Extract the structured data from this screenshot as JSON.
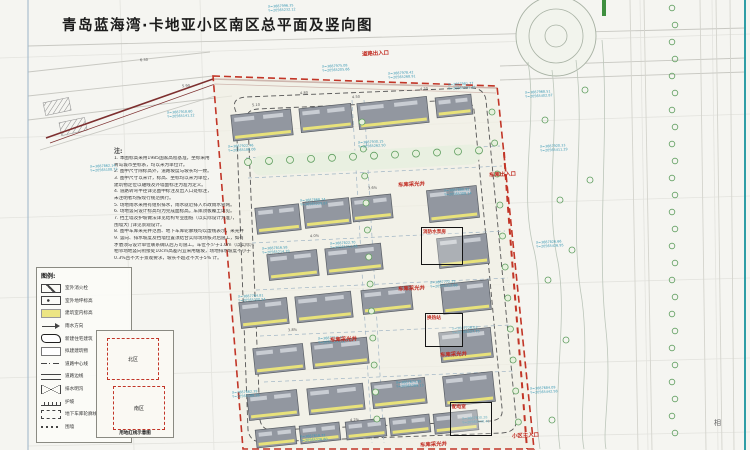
{
  "title": "青岛蓝海湾·卡地亚小区南区总平面及竖向图",
  "notes": {
    "header": "注:",
    "lines": [
      "1. 本图标高采用1985国家高程基准，坐标采用",
      "   青岛城市坐标系，均以米为单位计。",
      "2. 图中尺寸除标高外，道路坡度与坡长均一致。",
      "3. 图中尺寸以米计，标高、坐标均以米为单位，",
      "   建筑物定位以轴线及外墙面标注为准为定义。",
      "4. 道路转弯半径详见图中标注及出入口处标注，",
      "   未注明者均按现行规范执行。",
      "5. 场地雨水采用有组织排水，雨水就近排入市政雨水管网。",
      "6. 场地竖向设计标高均为完成面标高，车库顶板覆土详见。",
      "7. 挡土墙及护坡做法详见结构专业图纸（以实际设计为准），",
      "   围墙大门详见景观设计。",
      "8. 图中车库采光井范围、地下车库轮廓线均以虚线表示，采光井",
      "9. 竖向、排水坡度及挡墙位置须结合实际现场核对后施工，如有",
      "   矛盾须与设计单位联系确认后方可施工。车位不少于1.0m（以实际），",
      "   相邻场地竖向衔接处10cm高差内宜采用缓坡，场地排水坡度不小于",
      "   0.3%且不大于景观要求，坡长不超过不大于5% 计。"
    ]
  },
  "legend": {
    "header": "图例:",
    "items": [
      {
        "symbol": "hydrant-icon",
        "label": "室外消火栓"
      },
      {
        "symbol": "spot-level-icon",
        "label": "室外地坪标高"
      },
      {
        "symbol": "floor-level-icon",
        "label": "建筑室内标高"
      },
      {
        "symbol": "drain-arrow-icon",
        "label": "雨水方向"
      },
      {
        "symbol": "new-building-icon",
        "label": "新建住宅建筑"
      },
      {
        "symbol": "planned-building-icon",
        "label": "拟建建筑物"
      },
      {
        "symbol": "road-center-icon",
        "label": "道路中心线"
      },
      {
        "symbol": "road-edge-icon",
        "label": "道路边线"
      },
      {
        "symbol": "ditch-icon",
        "label": "排水明沟"
      },
      {
        "symbol": "slope-icon",
        "label": "护坡"
      },
      {
        "symbol": "garage-outline-icon",
        "label": "地下车库轮廓线"
      },
      {
        "symbol": "wall-icon",
        "label": "围墙"
      }
    ]
  },
  "keymap": {
    "north": "北区",
    "south": "南区",
    "caption": "用地红线示意图"
  },
  "map_labels": {
    "red": [
      {
        "text": "道路出入口",
        "x": 362,
        "y": 49
      },
      {
        "text": "车库采光井",
        "x": 398,
        "y": 180
      },
      {
        "text": "车库出入口",
        "x": 489,
        "y": 170
      },
      {
        "text": "车库采光井",
        "x": 398,
        "y": 284
      },
      {
        "text": "车库采光井",
        "x": 330,
        "y": 335
      },
      {
        "text": "车库采光井",
        "x": 440,
        "y": 350
      },
      {
        "text": "车库采光井",
        "x": 420,
        "y": 440
      },
      {
        "text": "小区主入口",
        "x": 512,
        "y": 431
      }
    ],
    "boxes": [
      {
        "label": "消防水泵房",
        "x": 421,
        "y": 227,
        "w": 42,
        "h": 38
      },
      {
        "label": "换热站",
        "x": 425,
        "y": 313,
        "w": 38,
        "h": 34
      },
      {
        "label": "配电室",
        "x": 450,
        "y": 402,
        "w": 42,
        "h": 34
      }
    ],
    "neighbor": "相"
  },
  "coord_labels": [
    {
      "x": 268,
      "y": 4,
      "l1": "X=3687996.35",
      "l2": "Y=20565232.12"
    },
    {
      "x": 322,
      "y": 64,
      "l1": "X=3687975.08",
      "l2": "Y=20565205.66"
    },
    {
      "x": 388,
      "y": 71,
      "l1": "X=3687978.42",
      "l2": "Y=20565268.91"
    },
    {
      "x": 448,
      "y": 82,
      "l1": "X=3687981.77",
      "l2": "Y=20565331.45"
    },
    {
      "x": 167,
      "y": 110,
      "l1": "X=3687918.60",
      "l2": "Y=20565141.22"
    },
    {
      "x": 90,
      "y": 164,
      "l1": "X=3687862.14",
      "l2": "Y=20565108.73"
    },
    {
      "x": 228,
      "y": 144,
      "l1": "X=3687922.46",
      "l2": "Y=20565186.08"
    },
    {
      "x": 358,
      "y": 140,
      "l1": "X=3687930.15",
      "l2": "Y=20565262.50"
    },
    {
      "x": 300,
      "y": 198,
      "l1": "X=3687868.34",
      "l2": "Y=20565229.87"
    },
    {
      "x": 444,
      "y": 188,
      "l1": "X=3687880.92",
      "l2": "Y=20565308.14"
    },
    {
      "x": 262,
      "y": 246,
      "l1": "X=3687816.58",
      "l2": "Y=20565214.39"
    },
    {
      "x": 330,
      "y": 241,
      "l1": "X=3687822.70",
      "l2": "Y=20565251.06"
    },
    {
      "x": 430,
      "y": 280,
      "l1": "X=3687772.25",
      "l2": "Y=20565312.68"
    },
    {
      "x": 238,
      "y": 294,
      "l1": "X=3687764.81",
      "l2": "Y=20565200.54"
    },
    {
      "x": 318,
      "y": 336,
      "l1": "X=3687712.47",
      "l2": "Y=20565244.92"
    },
    {
      "x": 452,
      "y": 326,
      "l1": "X=3687726.03",
      "l2": "Y=20565327.75"
    },
    {
      "x": 232,
      "y": 390,
      "l1": "X=3687662.39",
      "l2": "Y=20565188.26"
    },
    {
      "x": 396,
      "y": 380,
      "l1": "X=3687674.95",
      "l2": "Y=20565289.13"
    },
    {
      "x": 300,
      "y": 434,
      "l1": "X=3687618.72",
      "l2": "Y=20565226.60"
    },
    {
      "x": 462,
      "y": 416,
      "l1": "X=3687630.28",
      "l2": "Y=20565330.41"
    },
    {
      "x": 525,
      "y": 90,
      "l1": "X=3687968.51",
      "l2": "Y=20565402.87"
    },
    {
      "x": 540,
      "y": 144,
      "l1": "X=3687920.33",
      "l2": "Y=20565411.29"
    },
    {
      "x": 536,
      "y": 240,
      "l1": "X=3687826.66",
      "l2": "Y=20565426.95"
    },
    {
      "x": 530,
      "y": 386,
      "l1": "X=3687684.09",
      "l2": "Y=20565442.58"
    }
  ],
  "spot_elevations": [
    {
      "x": 352,
      "y": 95,
      "v": "4.50"
    },
    {
      "x": 300,
      "y": 91,
      "v": "4.80"
    },
    {
      "x": 252,
      "y": 103,
      "v": "5.10"
    },
    {
      "x": 420,
      "y": 87,
      "v": "4.20"
    },
    {
      "x": 140,
      "y": 58,
      "v": "6.30"
    },
    {
      "x": 182,
      "y": 84,
      "v": "5.90"
    },
    {
      "x": 368,
      "y": 186,
      "v": "3.6%"
    },
    {
      "x": 310,
      "y": 234,
      "v": "4.0%"
    },
    {
      "x": 288,
      "y": 328,
      "v": "3.8%"
    },
    {
      "x": 350,
      "y": 418,
      "v": "4.2%"
    }
  ],
  "colors": {
    "boundary_red": "#c23527",
    "coord_teal": "#3d9ab5",
    "building_gray": "#9297a0",
    "accent_yellow": "#e8e27a",
    "tree_green": "#5f9e5f",
    "road_maroon": "#7d2f2f",
    "frame_teal": "#2f9ea6"
  }
}
